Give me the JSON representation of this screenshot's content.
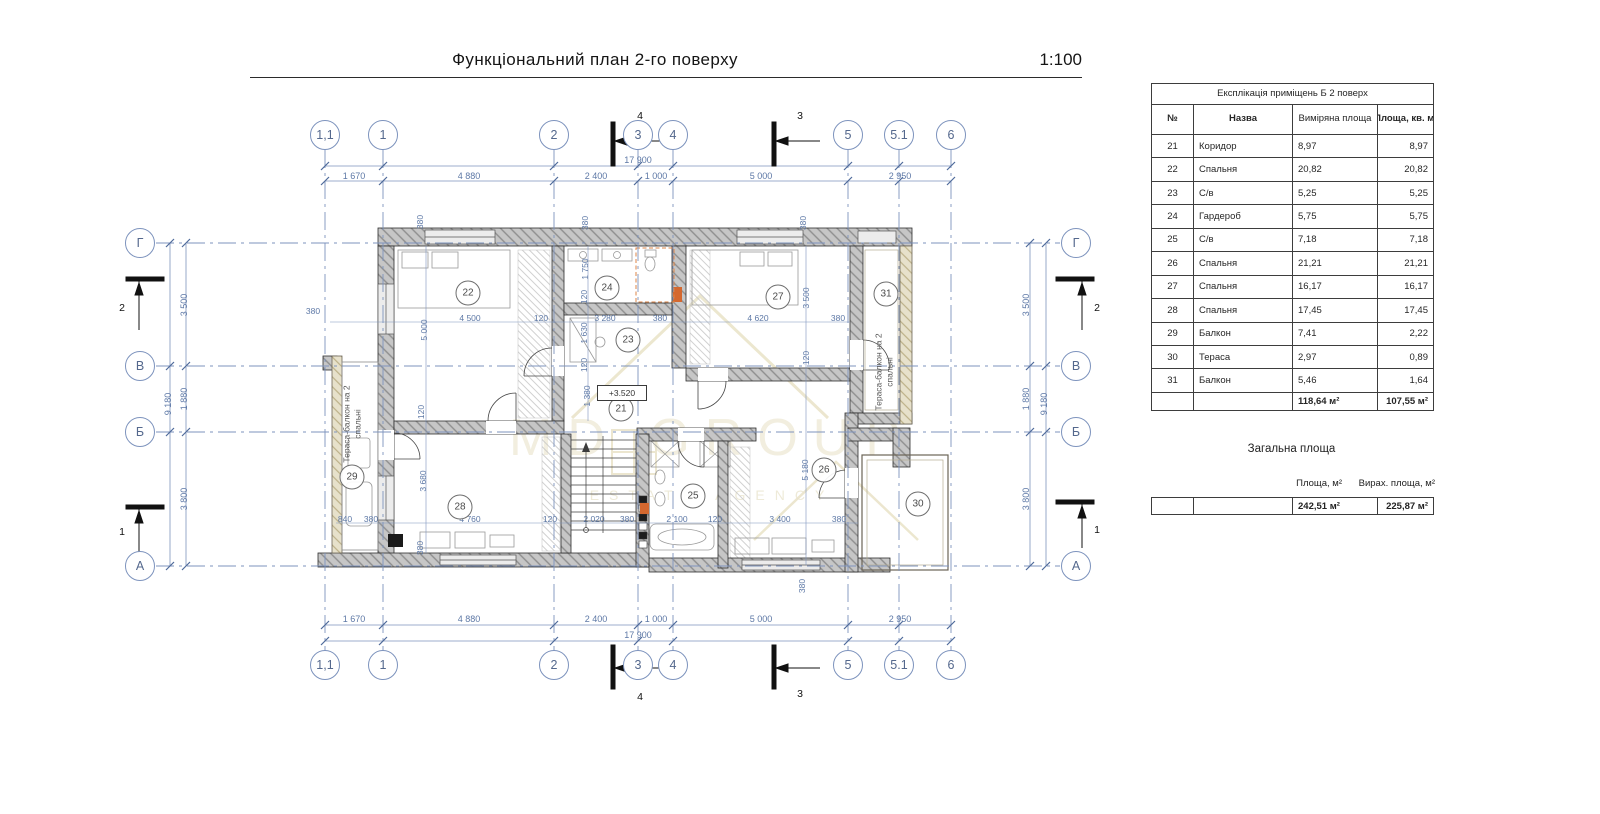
{
  "page_title": "Функціональний план 2-го поверху",
  "scale": "1:100",
  "colors": {
    "dim_blue": "#5d78a6",
    "grid_blue": "#7d93bd",
    "wall_gray": "#c6c6c6",
    "accent_orange": "#d4682f",
    "watermark_gold": "#d9cfa6"
  },
  "grid": {
    "columns": [
      "1,1",
      "1",
      "2",
      "3",
      "4",
      "5",
      "5.1",
      "6"
    ],
    "rows": [
      "Г",
      "В",
      "Б",
      "А"
    ]
  },
  "sections": {
    "top": [
      "4",
      "3"
    ],
    "bottom": [
      "4",
      "3"
    ],
    "left": [
      "2",
      "1"
    ],
    "right": [
      "2",
      "1"
    ]
  },
  "dimensions": {
    "top": [
      "1 670",
      "4 880",
      "2 400",
      "1 000",
      "5 000",
      "2 950"
    ],
    "top_total": "17 900",
    "bottom": [
      "1 670",
      "4 880",
      "2 400",
      "1 000",
      "5 000",
      "2 950"
    ],
    "bottom_total": "17 900",
    "left": [
      "3 500",
      "1 880",
      "3 800"
    ],
    "left_total": "9 180",
    "right": [
      "3 500",
      "1 880",
      "3 800"
    ],
    "right_total": "9 180",
    "plan_horizontal_mid": [
      "380",
      "4 500",
      "120",
      "3 280",
      "380",
      "4 620",
      "380"
    ],
    "plan_horizontal_bottom": [
      "840",
      "380",
      "4 760",
      "120",
      "2 020",
      "380",
      "2 100",
      "120",
      "3 400",
      "380"
    ],
    "plan_vertical": [
      "380",
      "380",
      "380",
      "5 000",
      "1 750",
      "120",
      "1 630",
      "120",
      "1 380",
      "3 500",
      "120",
      "5 180",
      "120",
      "3 680",
      "380",
      "380"
    ]
  },
  "rooms": [
    "21",
    "22",
    "23",
    "24",
    "25",
    "26",
    "27",
    "28",
    "29",
    "30",
    "31"
  ],
  "annotations": {
    "elevation": "+3.520",
    "terrace_label": "Тераса-балкон на 2 спальні"
  },
  "watermark": {
    "line1": "MD GROUP",
    "line2": "ESTATE AGENCY"
  },
  "exp_table": {
    "title": "Експлікація приміщень Б 2 поверх",
    "headers": [
      "№",
      "Назва",
      "Виміряна площа",
      "Площа, кв. м."
    ],
    "rows": [
      [
        "21",
        "Коридор",
        "8,97",
        "8,97"
      ],
      [
        "22",
        "Спальня",
        "20,82",
        "20,82"
      ],
      [
        "23",
        "С/в",
        "5,25",
        "5,25"
      ],
      [
        "24",
        "Гардероб",
        "5,75",
        "5,75"
      ],
      [
        "25",
        "С/в",
        "7,18",
        "7,18"
      ],
      [
        "26",
        "Спальня",
        "21,21",
        "21,21"
      ],
      [
        "27",
        "Спальня",
        "16,17",
        "16,17"
      ],
      [
        "28",
        "Спальня",
        "17,45",
        "17,45"
      ],
      [
        "29",
        "Балкон",
        "7,41",
        "2,22"
      ],
      [
        "30",
        "Тераса",
        "2,97",
        "0,89"
      ],
      [
        "31",
        "Балкон",
        "5,46",
        "1,64"
      ]
    ],
    "totals": [
      "118,64 м²",
      "107,55 м²"
    ]
  },
  "summary": {
    "heading": "Загальна площа",
    "col1": "Площа, м²",
    "col2": "Вирах. площа, м²",
    "val1": "242,51 м²",
    "val2": "225,87 м²"
  }
}
